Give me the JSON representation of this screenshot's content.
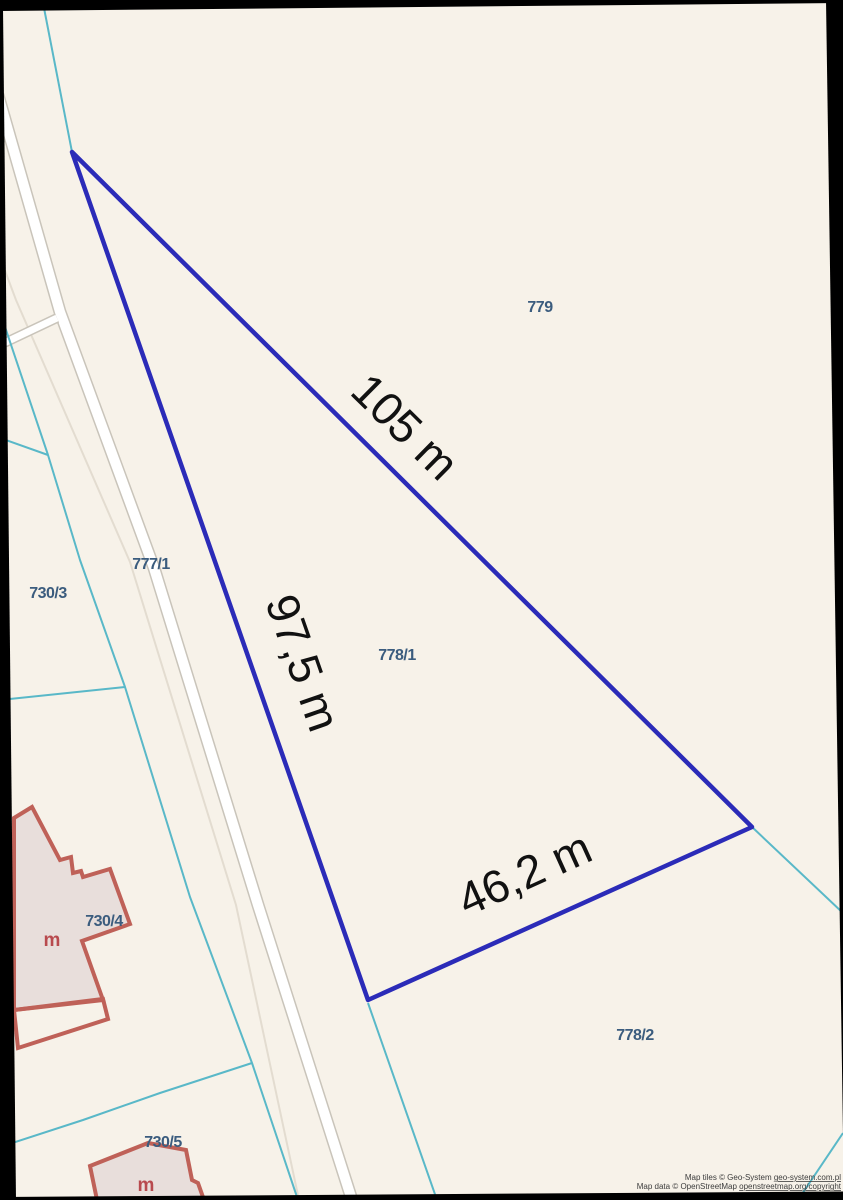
{
  "map": {
    "type": "cadastral-parcel-map",
    "parcels": [
      {
        "id": "779"
      },
      {
        "id": "777/1"
      },
      {
        "id": "730/3"
      },
      {
        "id": "778/1"
      },
      {
        "id": "730/4"
      },
      {
        "id": "730/5"
      },
      {
        "id": "778/2"
      }
    ],
    "highlighted_parcel": {
      "id": "778/1",
      "measurements": [
        {
          "label": "105 m"
        },
        {
          "label": "97,5 m"
        },
        {
          "label": "46,2 m"
        }
      ]
    },
    "buildings": [
      {
        "label": "m",
        "parcel": "730/4"
      },
      {
        "label": "m",
        "parcel": "730/5"
      }
    ],
    "attribution": {
      "tiles_prefix": "Map tiles © Geo-System ",
      "tiles_link": "geo-system.com.pl",
      "data_prefix": "Map data © OpenStreetMap ",
      "data_link": "openstreetmap.org/copyright"
    }
  },
  "colors": {
    "background": "#f7f2e9",
    "frame": "#000000",
    "highlight_stroke": "#2b2bb8",
    "boundary_cyan": "#59b8c8",
    "road_fill": "#ffffff",
    "road_casing": "#c9c4ba",
    "faint_line": "#e3dcd0",
    "building_fill": "#e8dedb",
    "building_stroke": "#bf6158",
    "building_label": "#b84a4e",
    "parcel_label": "#3b5c7e",
    "measurement_label": "#111111",
    "attribution_text": "#3c3c3c"
  }
}
